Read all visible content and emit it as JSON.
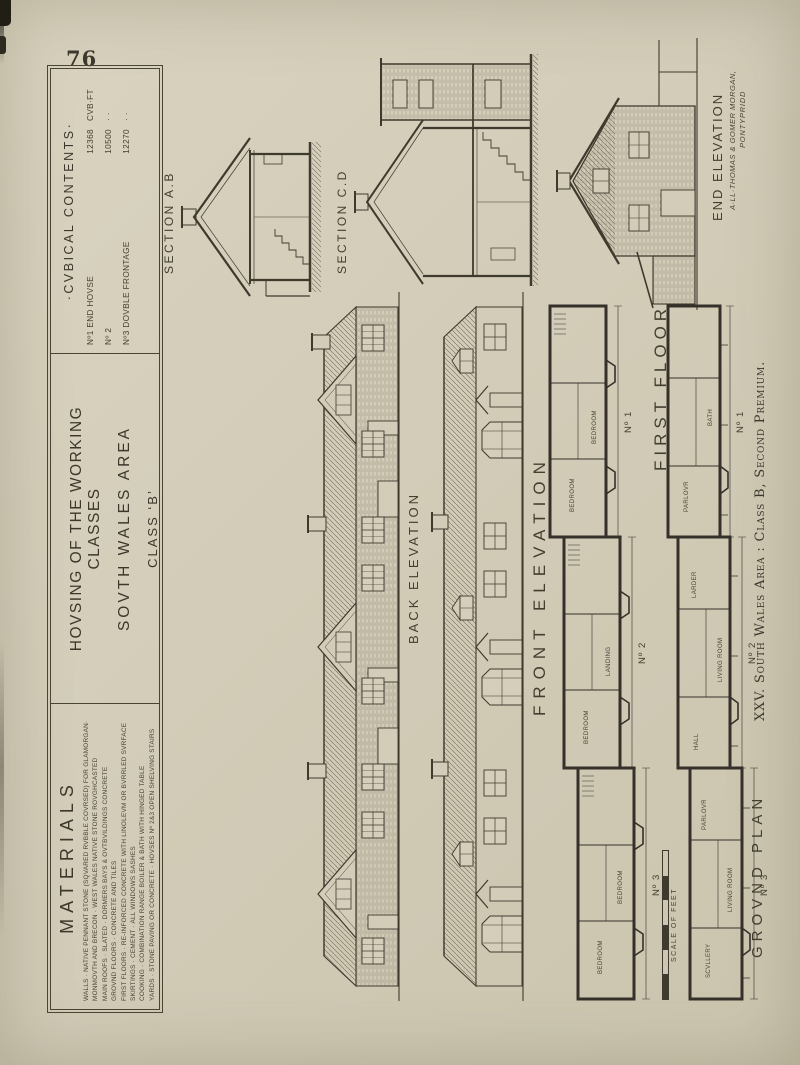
{
  "page": {
    "number": "76"
  },
  "caption": "XXV. South Wales Area : Class B, Second Premium.",
  "title_box": {
    "line1": "HOVSING OF THE WORKING CLASSES",
    "line2": "SOVTH WALES AREA",
    "line3": "CLASS ‘B’"
  },
  "materials": {
    "title": "MATERIALS",
    "lines": [
      "WALLS · NATIVE PENNANT STONE (SQVARED RVBBLE COVRSED) FOR GLAMORGAN·",
      "MONMOVTH AND BRECON · WEST WALES NATIVE STONE ROVGHCASTED",
      "MAIN ROOFS · SLATED · DORMERS BAYS & OVTBVILDINGS CONCRETE",
      "GROVND FLOORS · CONCRETE AND TILES",
      "FIRST FLOORS · RE-INFORCED CONCRETE WITH LINOLEVM OR BVRRLED SVRFACE",
      "SKIRTINGS · CEMENT · ALL WINDOWS SASHES",
      "COOKING · COMBINATION RANGE BOILER & BATH WITH HINGED TABLE",
      "YARDS · STONE PAVING OR CONCRETE · HOVSES Nº 2&3 OPEN SHELVING STAIRS"
    ]
  },
  "cubical": {
    "title": "·CVBICAL CONTENTS·",
    "rows": [
      {
        "name": "Nº1 END HOVSE",
        "value": "12368",
        "unit": "CVB·FT"
      },
      {
        "name": "Nº 2",
        "value": "10500",
        "unit": "·  ·"
      },
      {
        "name": "Nº3 DOVBLE FRONTAGE",
        "value": "12270",
        "unit": "·  ·"
      }
    ]
  },
  "labels": {
    "section_ab": "SECTION A.B",
    "section_cd": "SECTION C.D",
    "back_elevation": "BACK ELEVATION",
    "front_elevation": "FRONT ELEVATION",
    "end_elevation": "END ELEVATION",
    "first_floor": "FIRST FLOOR",
    "ground_plan": "GROVND PLAN",
    "scale": "SCALE OF FEET",
    "credit_line1": "A·LL·THOMAS & GOMER MORGAN,",
    "credit_line2": "PONTYPRIDD"
  },
  "plans": {
    "first_floor_units": [
      "Nº 3",
      "Nº 2",
      "Nº 1"
    ],
    "ground_units": [
      "Nº 3",
      "Nº 2",
      "Nº 1"
    ],
    "first_floor_rooms": [
      "BEDROOM",
      "BEDROOM",
      "BEDROOM",
      "LANDING",
      "BEDROOM",
      "BEDROOM"
    ],
    "ground_rooms": [
      "SCVLLERY",
      "LIVING ROOM",
      "PARLOVR",
      "HALL",
      "LIVING ROOM",
      "LARDER",
      "PARLOVR",
      "BATH"
    ]
  },
  "colors": {
    "paper": "#d2ccb8",
    "ink": "#3f3a2e"
  }
}
